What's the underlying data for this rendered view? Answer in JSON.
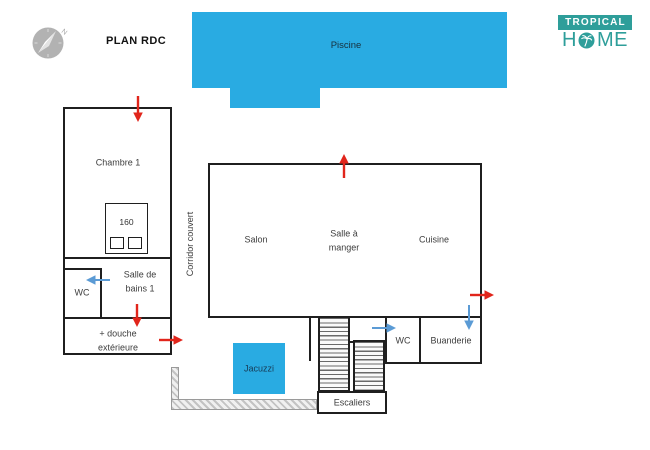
{
  "header": {
    "title": "PLAN RDC"
  },
  "brand": {
    "top": "TROPICAL",
    "home_h": "H",
    "home_me": "ME"
  },
  "compass": {
    "north": "N"
  },
  "colors": {
    "pool": "#29abe2",
    "brand": "#2e9e9a",
    "red": "#e1251b",
    "blue": "#5b9bd5",
    "wall": "#1f1f1f"
  },
  "areas": {
    "piscine": "Piscine",
    "jacuzzi": "Jacuzzi",
    "chambre1": "Chambre 1",
    "bed_size": "160",
    "wc1": "WC",
    "salle_de_bains": "Salle de\nbains 1",
    "douche": "+ douche\nextérieure",
    "corridor": "Corridor couvert",
    "salon": "Salon",
    "salle_a_manger": "Salle à\nmanger",
    "cuisine": "Cuisine",
    "escaliers": "Escaliers",
    "wc2": "WC",
    "buanderie": "Buanderie"
  }
}
